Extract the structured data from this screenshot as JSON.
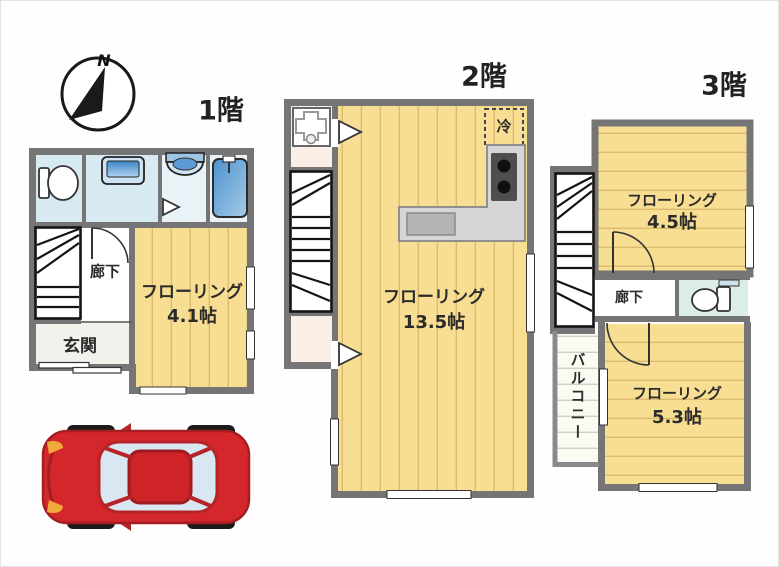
{
  "compass": {
    "north": "N"
  },
  "floor1": {
    "label": "1階",
    "flooring_name": "フローリング",
    "flooring_size": "4.1帖",
    "hallway": "廊下",
    "entrance": "玄関"
  },
  "floor2": {
    "label": "2階",
    "flooring_name": "フローリング",
    "flooring_size": "13.5帖",
    "refrigerator": "冷"
  },
  "floor3": {
    "label": "3階",
    "room_a_name": "フローリング",
    "room_a_size": "4.5帖",
    "hallway": "廊下",
    "balcony": "バルコニー",
    "room_b_name": "フローリング",
    "room_b_size": "5.3帖"
  },
  "colors": {
    "wall": "#757575",
    "flooring": "#F8DE93",
    "flooring_stripe": "#DDBA6E",
    "wet_room": "#D7E9F1",
    "cream_room": "#FAEEE6",
    "toilet_room": "#DCEDE6",
    "car_red": "#D3272B"
  }
}
